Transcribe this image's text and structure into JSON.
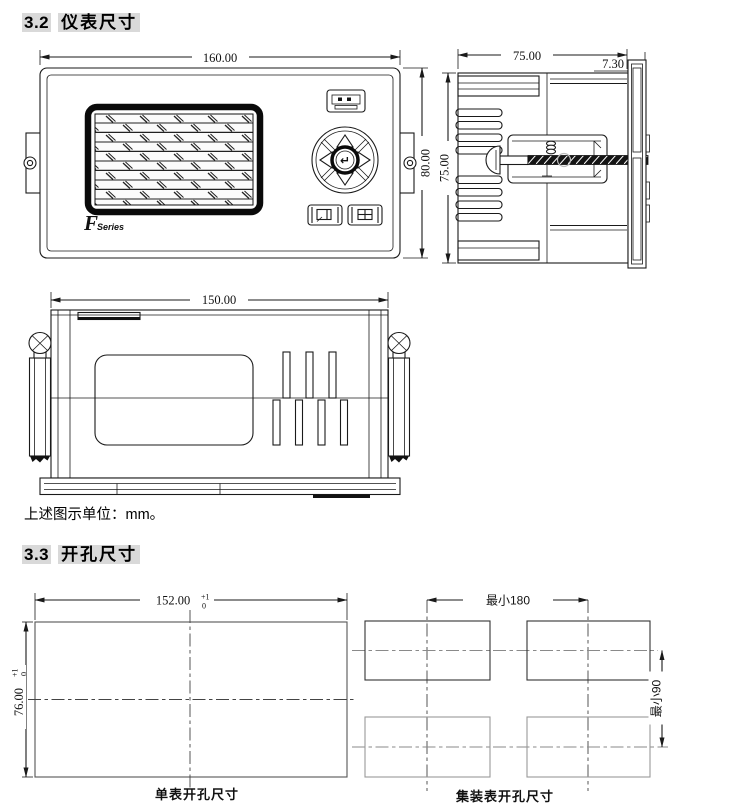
{
  "sections": {
    "s32": {
      "number": "3.2",
      "title": "仪表尺寸"
    },
    "s33": {
      "number": "3.3",
      "title": "开孔尺寸"
    }
  },
  "units_note": "上述图示单位：mm。",
  "front_view": {
    "width_dim": "160.00",
    "height_dim": "80.00",
    "logo_f": "F",
    "logo_series": "Series",
    "enter_key": "↵"
  },
  "side_view": {
    "depth_dim": "75.00",
    "bezel_dim": "7.30",
    "height_dim": "75.00"
  },
  "top_view": {
    "width_dim": "150.00"
  },
  "single_cutout": {
    "width_dim": "152.00",
    "width_tol_plus": "+1",
    "width_tol_minus": "0",
    "height_dim": "76.00",
    "height_tol_plus": "+1",
    "height_tol_minus": "0",
    "caption": "单表开孔尺寸"
  },
  "group_cutout": {
    "horizontal_dim": "最小180",
    "vertical_dim": "最小90",
    "caption": "集装表开孔尺寸"
  },
  "colors": {
    "highlight": "#d9d9d9",
    "line": "#1a1a1a"
  }
}
